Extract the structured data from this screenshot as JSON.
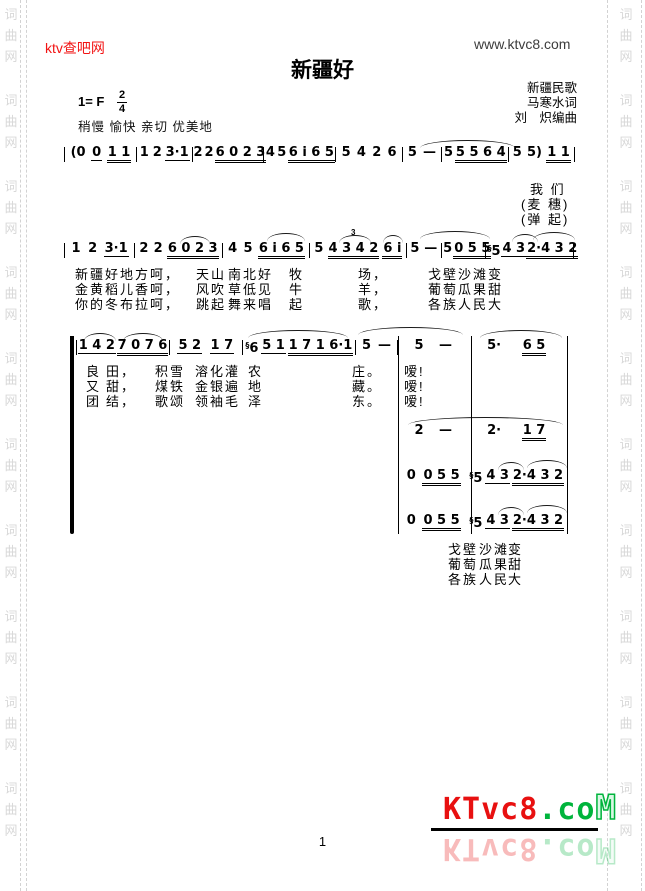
{
  "page": {
    "site_name": "ktv查吧网",
    "site_url": "www.ktvc8.com",
    "page_number": "1",
    "watermark_chars": [
      "词",
      "曲",
      "网"
    ],
    "logo": {
      "red_part": "KTvc8",
      "green_part": ".co",
      "outline_part": "M"
    },
    "colors": {
      "brand_red": "#e81010",
      "brand_green": "#00b43c",
      "site_red": "#f21414",
      "watermark_gray": "#d8d8d8"
    }
  },
  "header": {
    "title": "新疆好",
    "key": "1= F",
    "time_top": "2",
    "time_bottom": "4",
    "tempo": "稍慢 愉快 亲切 优美地",
    "credits": [
      "新疆民歌",
      "马寒水词",
      "刘　炽编曲"
    ]
  },
  "score": {
    "line1": {
      "measures": [
        [
          "(0",
          "_0",
          "=1 1"
        ],
        [
          "1",
          "2",
          "_3·1"
        ],
        [
          "2",
          "2",
          "=6 0 2 3"
        ],
        [
          "4",
          "5",
          "=6 i 6 5"
        ],
        [
          "5",
          "4",
          "2",
          "6"
        ],
        [
          "5",
          "—"
        ],
        [
          "5",
          "=5 5 6 4"
        ],
        [
          "5",
          "5)",
          "=1 1"
        ]
      ]
    },
    "line1_lyrics": {
      "row1": "我 们",
      "row2": "(麦 穗)",
      "row3": "(弹 起)"
    },
    "line2": {
      "triplet": "3",
      "measures": [
        [
          "1",
          "2",
          "_3·1"
        ],
        [
          "2",
          "2",
          "=6 0 2 3"
        ],
        [
          "4",
          "5",
          "=6 i 6 5"
        ],
        [
          "5",
          "=4 3 4 2",
          "=6 i"
        ],
        [
          "5",
          "—"
        ],
        [
          "5",
          "=0 5 5"
        ],
        [
          "§5",
          "_4 3",
          "=2·4 3 2"
        ]
      ]
    },
    "line2_lyrics": {
      "rows": [
        [
          "新疆好地方呵，",
          "天山",
          "南北好",
          "牧",
          "场，",
          "戈壁",
          "沙滩",
          "变"
        ],
        [
          "金黄稻儿香呵，",
          "风吹",
          "草低见",
          "牛",
          "羊，",
          "葡萄",
          "瓜果",
          "甜"
        ],
        [
          "你的冬布拉呵，",
          "跳起",
          "舞来唱",
          "起",
          "歌，",
          "各族",
          "人民",
          "大"
        ]
      ]
    },
    "line3": {
      "measures": [
        [
          "_1 4 2",
          "=7 0 7 6"
        ],
        [
          "_5 2",
          "_1 7"
        ],
        [
          "§6",
          "_5 1",
          "=1 7 1 6·1"
        ],
        [
          "5",
          "—"
        ]
      ]
    },
    "line3_lyrics": {
      "rows": [
        [
          "良",
          "田，",
          "积雪",
          "溶化灌",
          "农",
          "庄。"
        ],
        [
          "又",
          "甜，",
          "煤铁",
          "金银遍",
          "地",
          "藏。"
        ],
        [
          "团",
          "结，",
          "歌颂",
          "领袖毛",
          "泽",
          "东。"
        ]
      ],
      "exclaim": [
        "嗳!",
        "嗳!",
        "嗳!"
      ]
    },
    "system": {
      "voices": [
        {
          "measures": [
            [
              "5",
              "—"
            ],
            [
              "5·",
              "=6 5"
            ]
          ]
        },
        {
          "measures": [
            [
              "2",
              "—"
            ],
            [
              "2·",
              "=1 7"
            ]
          ]
        },
        {
          "measures": [
            [
              "0",
              "=0 5 5"
            ],
            [
              "§5",
              "_4 3",
              "=2·4 3 2"
            ]
          ]
        },
        {
          "measures": [
            [
              "0",
              "=0 5 5"
            ],
            [
              "§5",
              "_4 3",
              "=2·4 3 2"
            ]
          ]
        }
      ],
      "lyrics": {
        "rows": [
          [
            "戈壁",
            "沙滩",
            "变"
          ],
          [
            "葡萄",
            "瓜果",
            "甜"
          ],
          [
            "各族",
            "人民",
            "大"
          ]
        ]
      }
    }
  }
}
